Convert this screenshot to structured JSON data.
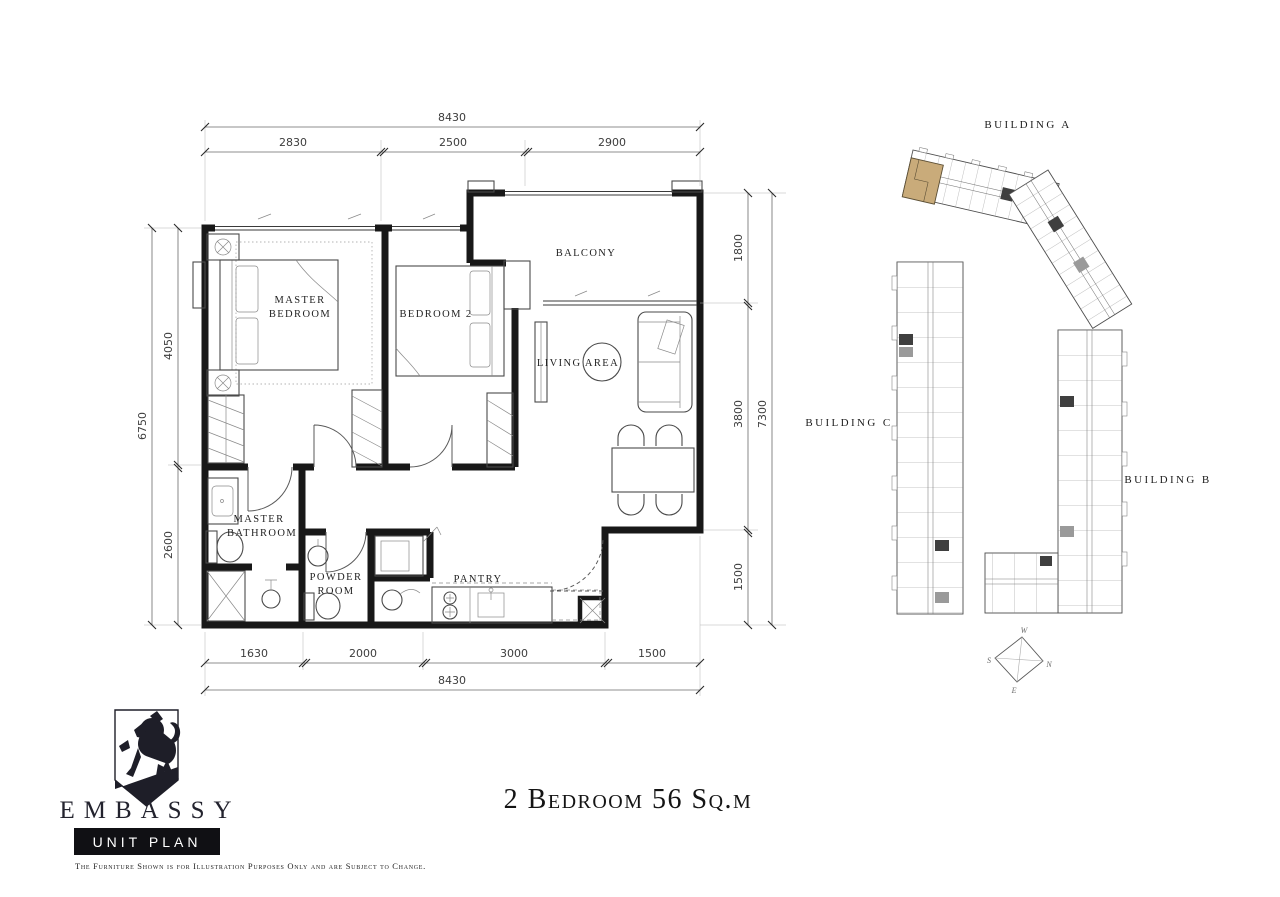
{
  "title": "2 Bedroom 56 Sq.m",
  "brand": {
    "name": "EMBASSY",
    "badge": "UNIT PLAN",
    "disclaimer": "The Furniture Shown is for Illustration Purposes Only and are Subject to Change."
  },
  "floorplan": {
    "rooms": {
      "master_bedroom": [
        "MASTER",
        "BEDROOM"
      ],
      "bedroom2": "BEDROOM 2",
      "balcony": "BALCONY",
      "living": "LIVING AREA",
      "master_bathroom": [
        "MASTER",
        "BATHROOM"
      ],
      "powder": [
        "POWDER",
        "ROOM"
      ],
      "pantry": "PANTRY"
    },
    "dims": {
      "top": {
        "total": "8430",
        "segments": [
          "2830",
          "2500",
          "2900"
        ]
      },
      "bottom": {
        "total": "8430",
        "segments": [
          "1630",
          "2000",
          "3000",
          "1500"
        ]
      },
      "left": {
        "total": "6750",
        "segments": [
          "4050",
          "2600"
        ]
      },
      "right": {
        "total": "7300",
        "segments": [
          "1800",
          "3800",
          "1500"
        ]
      }
    }
  },
  "site_plan": {
    "buildings": [
      {
        "id": "A",
        "label": "BUILDING A"
      },
      {
        "id": "C",
        "label": "BUILDING C"
      },
      {
        "id": "B",
        "label": "BUILDING B"
      }
    ],
    "highlight_color": "#c9ab7a",
    "compass": {
      "n": "N",
      "s": "S",
      "e": "E",
      "w": "W"
    }
  }
}
